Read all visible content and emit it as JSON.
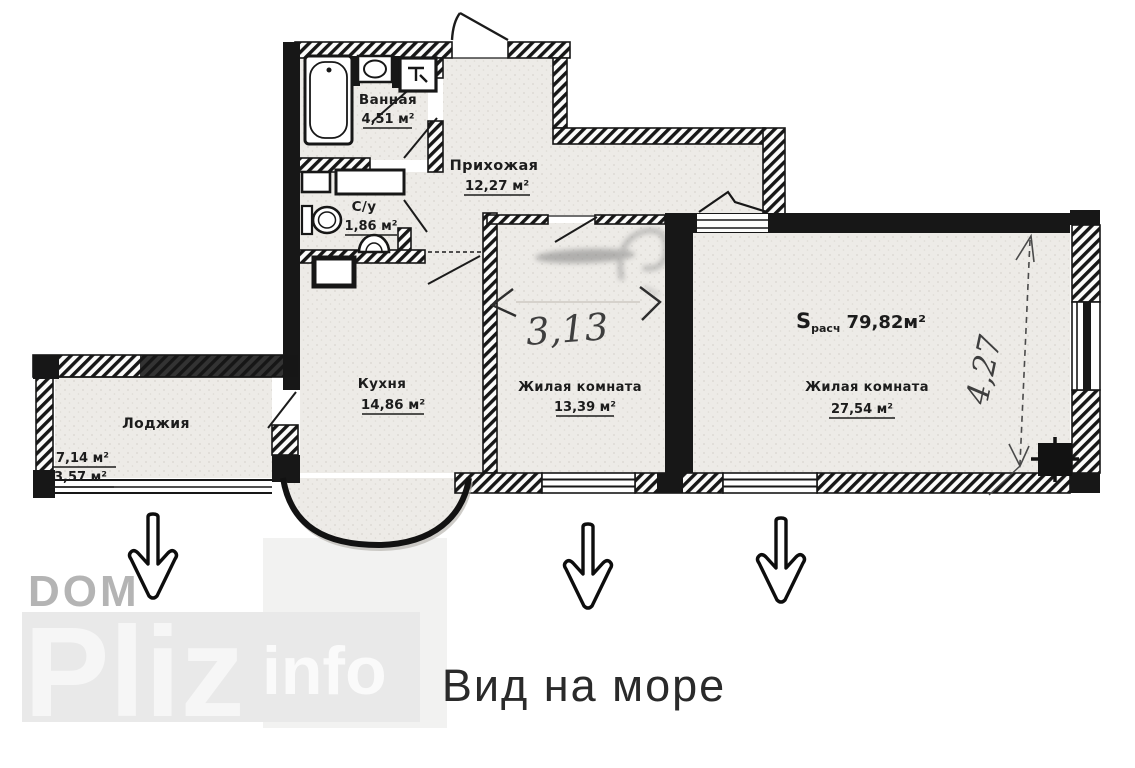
{
  "plan": {
    "rooms": {
      "bathroom": {
        "name": "Ванная",
        "area": "4,51 м²"
      },
      "wc": {
        "name": "С/у",
        "area": "1,86 м²"
      },
      "hallway": {
        "name": "Прихожая",
        "area": "12,27 м²"
      },
      "kitchen": {
        "name": "Кухня",
        "area": "14,86 м²"
      },
      "living1": {
        "name": "Жилая комната",
        "area": "13,39 м²"
      },
      "living2": {
        "name": "Жилая комната",
        "area": "27,54 м²"
      },
      "loggia": {
        "name": "Лоджия",
        "area_full": "7,14 м²",
        "area_reduced": "3,57 м²"
      }
    },
    "total": {
      "label": "S",
      "subscript": "расч",
      "value": "79,82м²"
    },
    "handwritten": {
      "width_living1": "3,13",
      "depth_living2": "4,27"
    }
  },
  "watermark": {
    "top": "DOM",
    "main": "Pliz",
    "suffix": "info"
  },
  "caption": "Вид на море",
  "colors": {
    "wall": "#171717",
    "floor": "#edebe7",
    "watermark_gray": "#b4b4b4",
    "watermark_light": "#f6f6f6",
    "watermark_band": "#e9e9e9",
    "caption_color": "#2a2a2a",
    "handwriting": "#3e3e3e"
  }
}
